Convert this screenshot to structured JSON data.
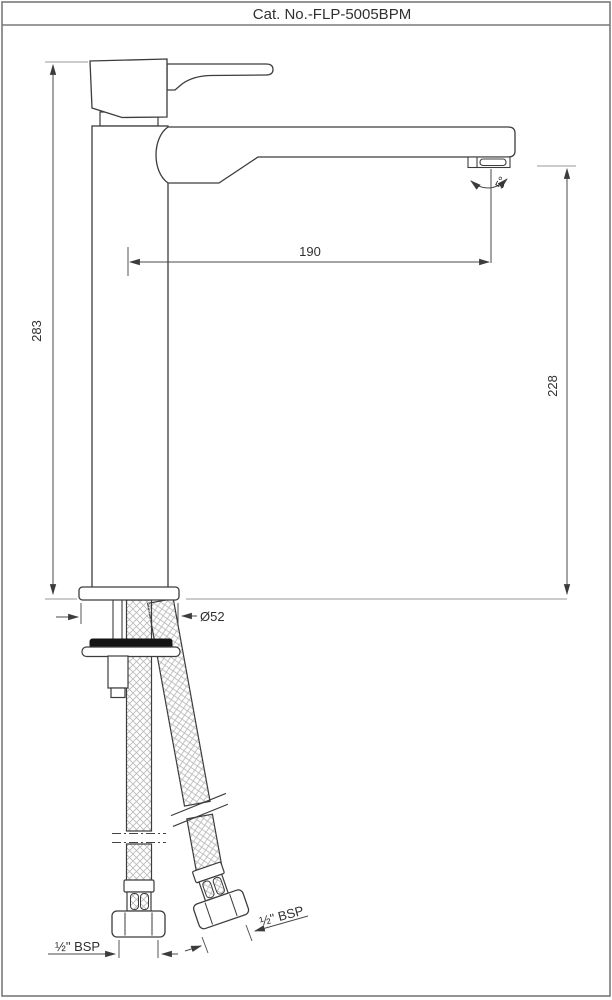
{
  "page": {
    "title": "Cat. No.-FLP-5005BPM"
  },
  "drawing": {
    "type": "technical-dimension-drawing",
    "dimensions": {
      "overall_height": "283",
      "spout_reach": "190",
      "spout_outlet_height": "228",
      "base_diameter": "Ø52",
      "spout_angle": "5°",
      "left_hose_thread": "½\" BSP",
      "right_hose_thread": "½\" BSP"
    },
    "colors": {
      "outline": "#3c3c3c",
      "dimension": "#4a4a4a",
      "extension": "#9a9a9a",
      "hatch": "#b8b8b8",
      "locknut_fill": "#141414",
      "border": "#7a7a7a"
    }
  }
}
